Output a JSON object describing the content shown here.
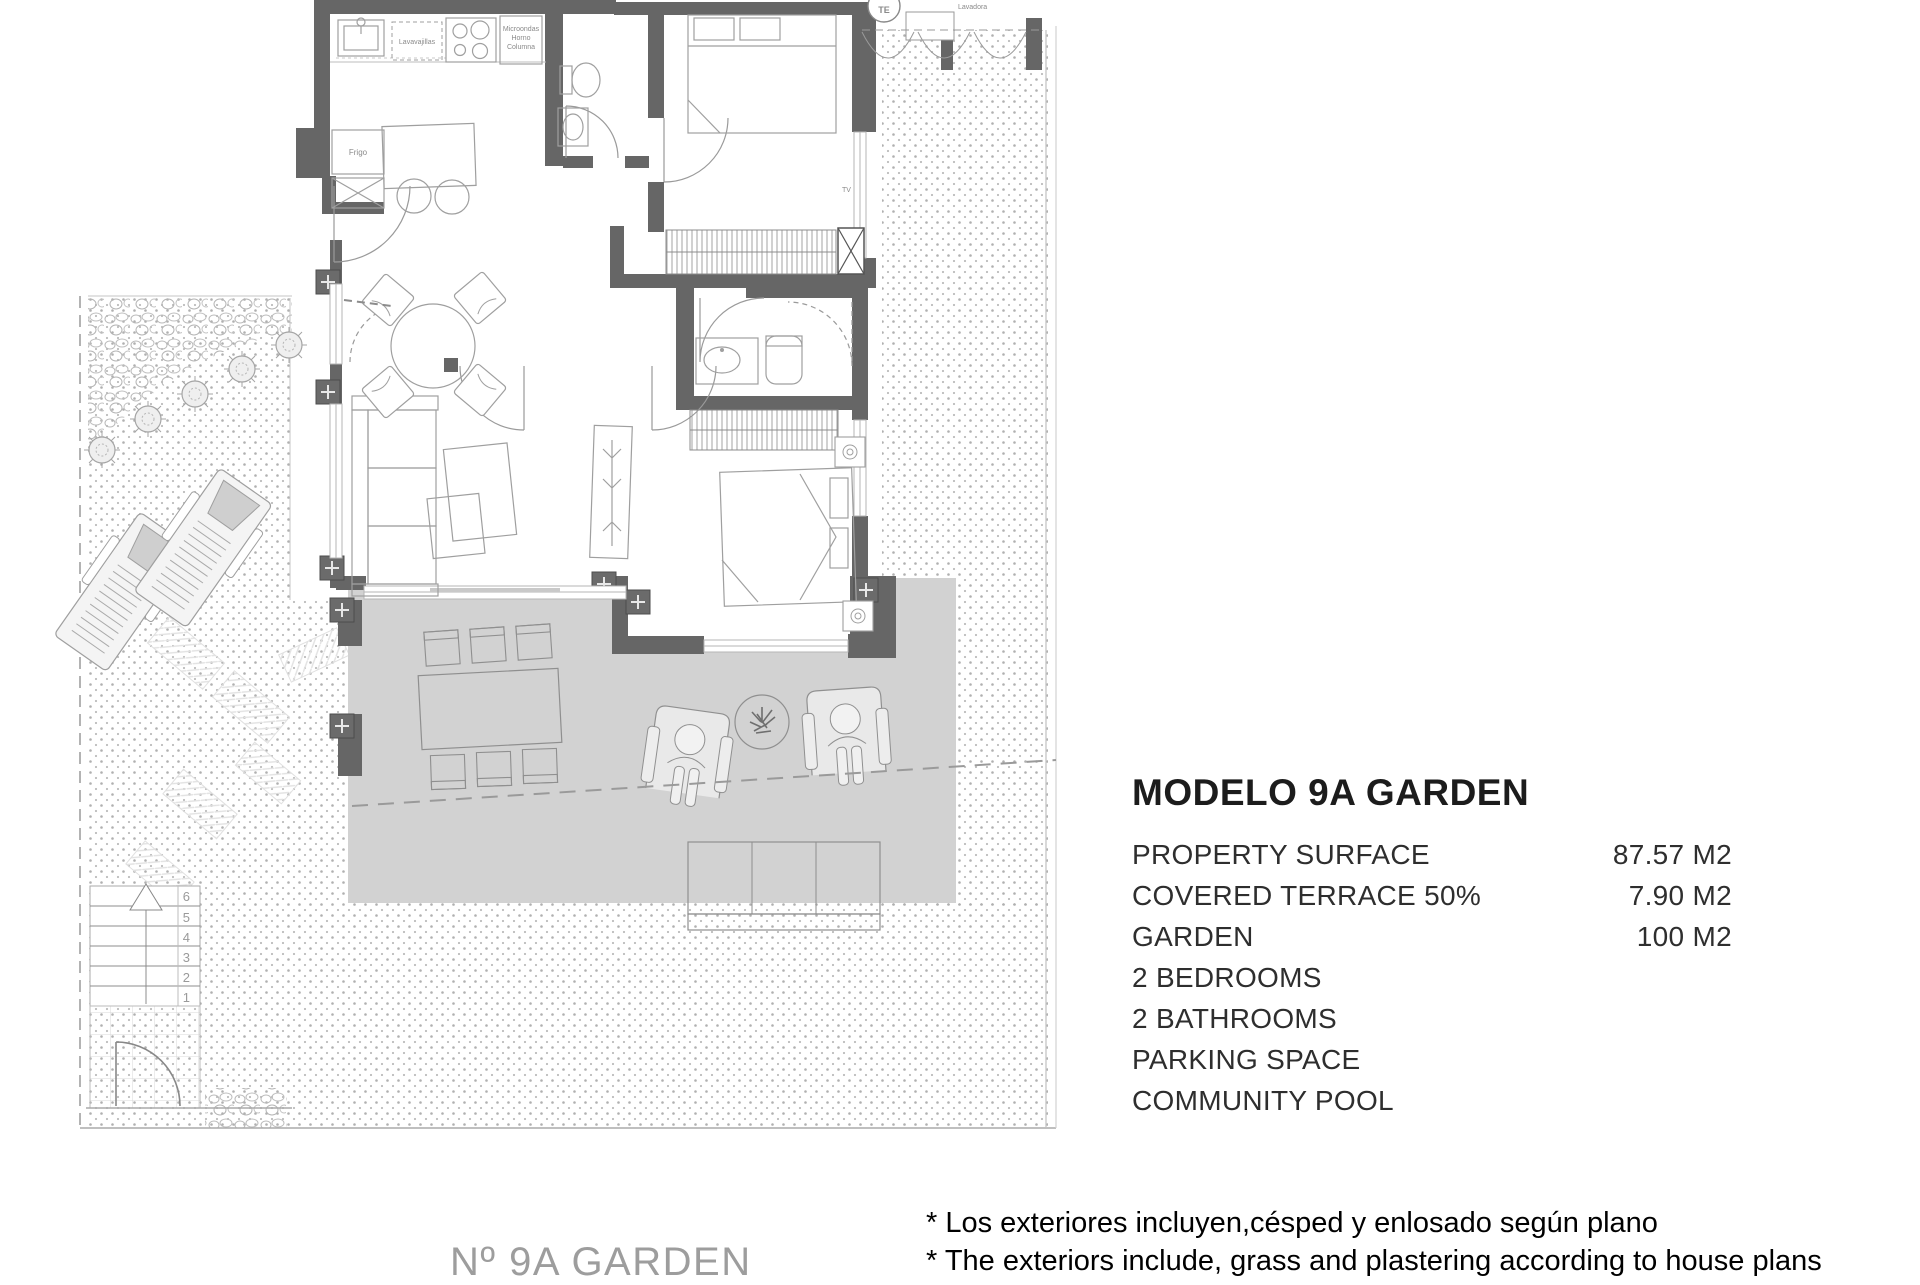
{
  "info_panel": {
    "title": "MODELO 9A GARDEN",
    "specs": [
      {
        "label": "PROPERTY SURFACE",
        "value": "87.57 M2"
      },
      {
        "label": "COVERED TERRACE 50%",
        "value": "7.90 M2"
      },
      {
        "label": "GARDEN",
        "value": "100 M2"
      }
    ],
    "features": [
      "2 BEDROOMS",
      "2 BATHROOMS",
      "PARKING SPACE",
      "COMMUNITY POOL"
    ]
  },
  "footnotes": {
    "line1_es": "* Los exteriores incluyen,césped y enlosado según plano",
    "line2_en": "* The exteriors include, grass and plastering according to house plans"
  },
  "plan_footer": {
    "unit_label": "Nº 9A GARDEN"
  },
  "floor_plan": {
    "labels": {
      "dishwasher": "Lavavajillas",
      "micro1": "Microondas",
      "micro2": "Horno",
      "micro3": "Columna",
      "fridge": "Frigo",
      "washer": "Lavadora",
      "electrical_panel": "TE",
      "tv": "TV",
      "stair_steps": [
        "1",
        "2",
        "3",
        "4",
        "5",
        "6"
      ]
    },
    "colors": {
      "wall": "#666666",
      "furniture_line": "#9f9f9f",
      "terrace_fill": "#d2d2d2",
      "garden_dot": "#b0b0b0",
      "label_gray": "#8a8a8a",
      "title_text": "#1c1c1c",
      "body_text": "#2e2e2e",
      "footnote_text": "#000000",
      "footer_gray": "#9d9d9d"
    }
  }
}
